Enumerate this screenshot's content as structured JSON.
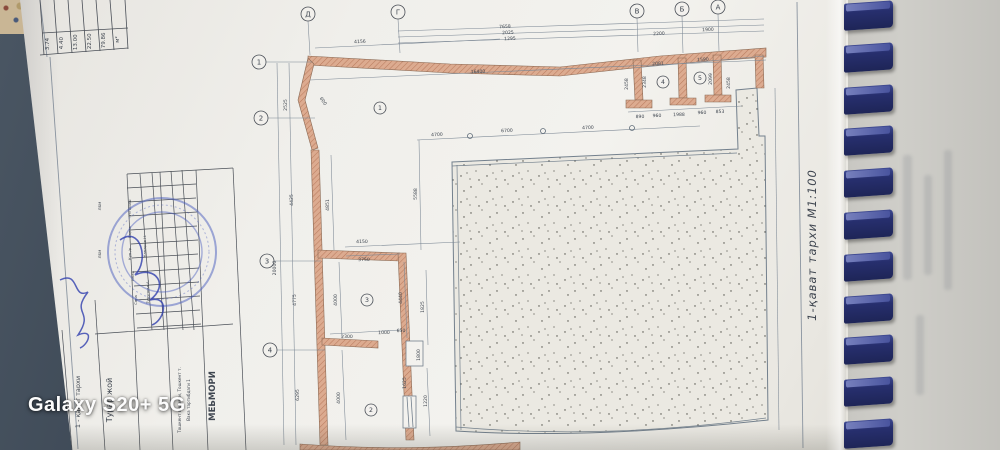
{
  "photo": {
    "watermark": "Galaxy S20+ 5G"
  },
  "sheet": {
    "title_vertical": "1-қават тархи М1:100",
    "grid_axes_top": [
      {
        "label": "Д",
        "x": 308,
        "y": 14
      },
      {
        "label": "Г",
        "x": 398,
        "y": 12
      },
      {
        "label": "В",
        "x": 637,
        "y": 11
      },
      {
        "label": "Б",
        "x": 682,
        "y": 9
      },
      {
        "label": "А",
        "x": 718,
        "y": 7
      }
    ],
    "grid_axes_left": [
      {
        "label": "1",
        "x": 259,
        "y": 62
      },
      {
        "label": "2",
        "x": 261,
        "y": 118
      },
      {
        "label": "3",
        "x": 267,
        "y": 261
      },
      {
        "label": "4",
        "x": 270,
        "y": 350
      }
    ],
    "room_numbers": [
      {
        "label": "1",
        "x": 380,
        "y": 108
      },
      {
        "label": "2",
        "x": 371,
        "y": 410
      },
      {
        "label": "3",
        "x": 367,
        "y": 300
      },
      {
        "label": "4",
        "x": 663,
        "y": 82
      },
      {
        "label": "5",
        "x": 700,
        "y": 78
      }
    ],
    "dimensions": [
      {
        "t": "4156",
        "x": 360,
        "y": 43,
        "r": -3
      },
      {
        "t": "7658",
        "x": 505,
        "y": 28,
        "r": -2
      },
      {
        "t": "2025",
        "x": 508,
        "y": 34,
        "r": -2
      },
      {
        "t": "1295",
        "x": 510,
        "y": 40,
        "r": -2
      },
      {
        "t": "2200",
        "x": 659,
        "y": 35,
        "r": -2
      },
      {
        "t": "1900",
        "x": 708,
        "y": 31,
        "r": -2
      },
      {
        "t": "16400",
        "x": 478,
        "y": 73,
        "r": -2
      },
      {
        "t": "2081",
        "x": 658,
        "y": 65,
        "r": -2
      },
      {
        "t": "1590",
        "x": 703,
        "y": 61,
        "r": -2
      },
      {
        "t": "890",
        "x": 640,
        "y": 118,
        "r": -1
      },
      {
        "t": "960",
        "x": 657,
        "y": 117,
        "r": -1
      },
      {
        "t": "1988",
        "x": 679,
        "y": 116,
        "r": -1
      },
      {
        "t": "960",
        "x": 702,
        "y": 114,
        "r": -1
      },
      {
        "t": "853",
        "x": 720,
        "y": 113,
        "r": -1
      },
      {
        "t": "4700",
        "x": 437,
        "y": 136,
        "r": -2
      },
      {
        "t": "6700",
        "x": 507,
        "y": 132,
        "r": -2
      },
      {
        "t": "4700",
        "x": 588,
        "y": 129,
        "r": -2
      },
      {
        "t": "4150",
        "x": 362,
        "y": 243,
        "r": -1
      },
      {
        "t": "3750",
        "x": 364,
        "y": 261,
        "r": -1
      },
      {
        "t": "2300",
        "x": 347,
        "y": 338,
        "r": -1
      },
      {
        "t": "1000",
        "x": 384,
        "y": 334,
        "r": -1
      },
      {
        "t": "650",
        "x": 401,
        "y": 332,
        "r": -1
      },
      {
        "t": "2525",
        "x": 287,
        "y": 105,
        "r": -90
      },
      {
        "t": "4425",
        "x": 293,
        "y": 200,
        "r": -90
      },
      {
        "t": "4775",
        "x": 296,
        "y": 300,
        "r": -90
      },
      {
        "t": "6295",
        "x": 299,
        "y": 395,
        "r": -90
      },
      {
        "t": "20000",
        "x": 276,
        "y": 268,
        "r": -90
      },
      {
        "t": "4851",
        "x": 329,
        "y": 205,
        "r": -90
      },
      {
        "t": "5588",
        "x": 417,
        "y": 194,
        "r": -90
      },
      {
        "t": "4000",
        "x": 337,
        "y": 300,
        "r": -90
      },
      {
        "t": "4000",
        "x": 340,
        "y": 398,
        "r": -90
      },
      {
        "t": "4440",
        "x": 402,
        "y": 298,
        "r": -90
      },
      {
        "t": "2458",
        "x": 628,
        "y": 84,
        "r": -90
      },
      {
        "t": "2348",
        "x": 646,
        "y": 82,
        "r": -90
      },
      {
        "t": "2099",
        "x": 712,
        "y": 79,
        "r": -90
      },
      {
        "t": "2458",
        "x": 730,
        "y": 83,
        "r": -90
      },
      {
        "t": "1825",
        "x": 424,
        "y": 307,
        "r": -90
      },
      {
        "t": "1220",
        "x": 427,
        "y": 401,
        "r": -90
      },
      {
        "t": "1800",
        "x": 420,
        "y": 355,
        "r": -90
      },
      {
        "t": "1625",
        "x": 406,
        "y": 383,
        "r": -90
      },
      {
        "t": "600",
        "x": 322,
        "y": 102,
        "r": 55
      }
    ],
    "area_table": {
      "columns": [
        "3.74",
        "4.40",
        "13.00",
        "22.50",
        "79.86",
        "м²"
      ]
    },
    "title_block": {
      "texts": [
        {
          "t": "МЕЬМОРИ",
          "x": 215,
          "y": 396,
          "fs": 8.5,
          "b": 1
        },
        {
          "t": "Вака тартибдаги 1",
          "x": 190,
          "y": 400,
          "fs": 4.2,
          "b": 0
        },
        {
          "t": "Тошкент вилояти, Тошкент т.",
          "x": 181,
          "y": 400,
          "fs": 4.2,
          "b": 0
        },
        {
          "t": "Турар жой",
          "x": 112,
          "y": 400,
          "fs": 8,
          "b": 0
        },
        {
          "t": "1 - қават тархи",
          "x": 80,
          "y": 402,
          "fs": 6.5,
          "b": 0
        }
      ],
      "stamp_cells": [
        {
          "t": "ЛБМ",
          "x": 101,
          "y": 206
        },
        {
          "t": "ЛБМ",
          "x": 101,
          "y": 254
        },
        {
          "t": "Узгариш",
          "x": 131,
          "y": 208
        },
        {
          "t": "Варак",
          "x": 131,
          "y": 232
        },
        {
          "t": "Кув./р",
          "x": 131,
          "y": 254
        },
        {
          "t": "Имзо",
          "x": 134,
          "y": 276
        },
        {
          "t": "Сана",
          "x": 137,
          "y": 300
        },
        {
          "t": "Камаров Н.",
          "x": 146,
          "y": 246
        },
        {
          "t": "Турунова А.",
          "x": 149,
          "y": 292
        }
      ]
    }
  },
  "binding": {
    "teeth_count": 11
  },
  "colors": {
    "wall_fill": "#dcab90",
    "wall_hatch": "#bb7c5f",
    "line": "#73808d",
    "dim_text": "#3f4650",
    "comb": "#272f6e",
    "paper": "#f0efeb",
    "under_page": "#c9c8c3",
    "stamp_blue": "#4a56b8"
  }
}
